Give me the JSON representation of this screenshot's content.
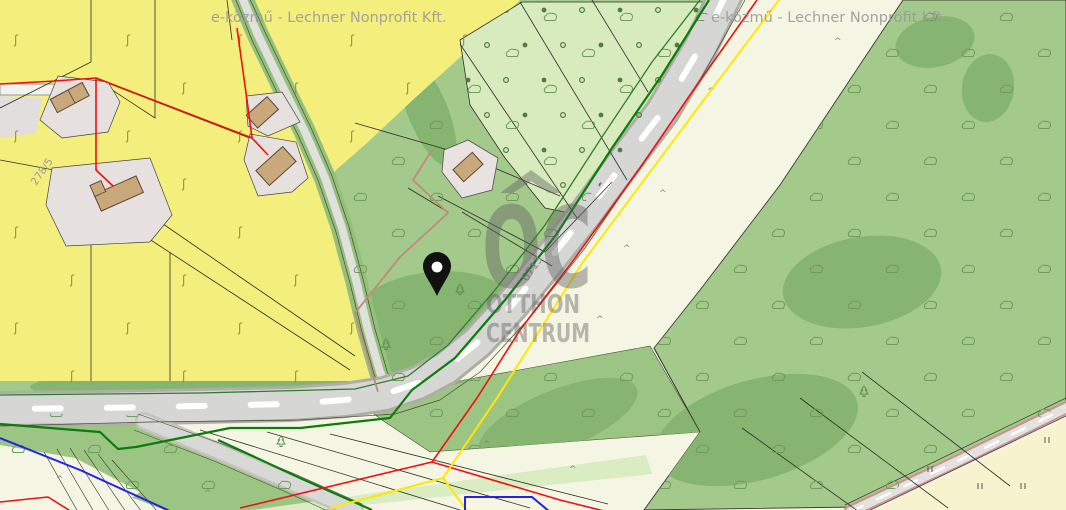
{
  "map": {
    "attribution": "e-közmű - Lechner Nonprofit Kft.",
    "road_label": "6713",
    "parcel_label": "278/5",
    "watermark": {
      "logo": "OC",
      "line1": "OTTHON",
      "line2": "CENTRUM"
    },
    "marker": {
      "type": "location-pin",
      "color": "#111111"
    },
    "colors": {
      "parcel_yellow": "#f4ef7d",
      "forest_green": "#a3c98b",
      "orchard_light_green": "#d7ebbc",
      "dark_green_patch": "#86b471",
      "ivory": "#f5f5e4",
      "pale_yellow": "#f8f3cf",
      "road_fill": "#d6d6d4",
      "utility_red": "#f01010",
      "utility_yellow": "#ffe800",
      "utility_blue": "#2222e8",
      "utility_green": "#0b7d0b",
      "building_tan": "#c9a87c",
      "courtyard_gray": "#e6e0de",
      "selected_boundary_salmon": "#c08a7c",
      "watermark_gray": "#5f5f5f",
      "attribution_gray": "#9a9a9a"
    },
    "symbols": {
      "grass": "grass-tuft-symbol",
      "bush": "bush-symbol",
      "conifer": "conifer-tree-symbol",
      "orchard_dot": "orchard-dot-symbol",
      "caret": "scrub-symbol",
      "double_bar": "vineyard-symbol"
    }
  }
}
